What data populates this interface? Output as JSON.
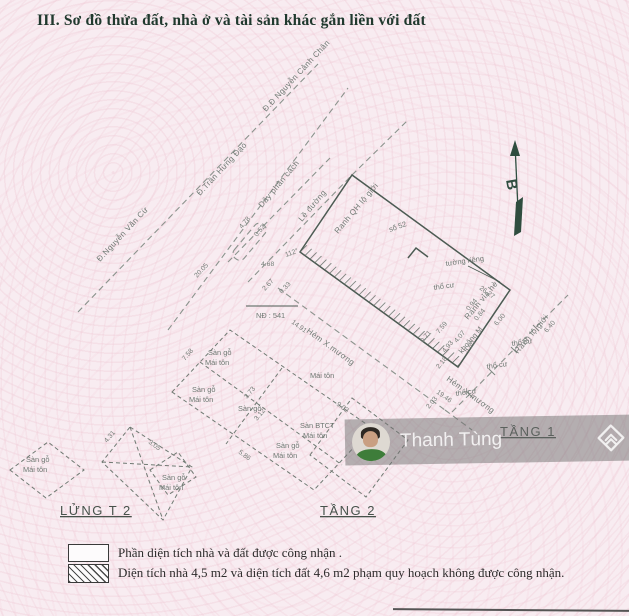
{
  "title": "III. Sơ đồ thửa đất, nhà ở và tài sản khác gắn liền với đất",
  "watermark": {
    "name": "Thanh Tùng",
    "avatar": "man-portrait-photo",
    "logo": "diamond-chevron-logo"
  },
  "legend": {
    "items": [
      {
        "swatch": "empty-box",
        "text": "Phần diện tích nhà và đất được công nhận ."
      },
      {
        "swatch": "hatched-box",
        "text": "Diện tích nhà 4,5 m2 và diện tích đất 4,6 m2 phạm quy hoạch không được công nhận."
      }
    ]
  },
  "colors": {
    "paper": "#f8ecf1",
    "ink": "#20392e",
    "line": "#55645c",
    "band": "rgba(112,112,112,0.5)",
    "shirt_green": "#3e7d3a"
  },
  "diagram": {
    "texts": [
      {
        "t": "Đ.Nguyễn Văn Cừ",
        "x": 100,
        "y": 262,
        "r": -47,
        "c": "road"
      },
      {
        "t": "Đ.Trần Hưng Đạo",
        "x": 200,
        "y": 196,
        "r": -47,
        "c": "road"
      },
      {
        "t": "Đ.Đ Nguyễn Cảnh Chân",
        "x": 266,
        "y": 112,
        "r": -47,
        "c": "road"
      },
      {
        "t": "Dây phân cách",
        "x": 262,
        "y": 208,
        "r": -50,
        "c": "road"
      },
      {
        "t": "Lề đường",
        "x": 302,
        "y": 222,
        "r": -50,
        "c": "road"
      },
      {
        "t": "Ranh QH lộ giới",
        "x": 338,
        "y": 234,
        "r": -50,
        "c": "road"
      },
      {
        "t": "Hẻm X.mương",
        "x": 306,
        "y": 332,
        "r": 36,
        "c": "road"
      },
      {
        "t": "Hẻm X.mương",
        "x": 446,
        "y": 380,
        "r": 36,
        "c": "road"
      },
      {
        "t": "Ranh vỉa hè",
        "x": 468,
        "y": 320,
        "r": -50,
        "c": "road"
      },
      {
        "t": "Ranh lộ giới",
        "x": 518,
        "y": 354,
        "r": -50,
        "c": "road"
      },
      {
        "t": "tường riêng",
        "x": 446,
        "y": 266,
        "r": -8,
        "c": "ann"
      },
      {
        "t": "thổ cư",
        "x": 434,
        "y": 290,
        "r": -8,
        "c": "ann"
      },
      {
        "t": "thổ cư",
        "x": 512,
        "y": 346,
        "r": -8,
        "c": "ann"
      },
      {
        "t": "thổ cư",
        "x": 487,
        "y": 369,
        "r": -8,
        "c": "ann"
      },
      {
        "t": "thổ cư",
        "x": 456,
        "y": 396,
        "r": -8,
        "c": "ann"
      },
      {
        "t": "số 52",
        "x": 390,
        "y": 232,
        "r": -20,
        "c": "ann"
      },
      {
        "t": "NĐ : 541",
        "x": 256,
        "y": 318,
        "r": 0,
        "c": "ann"
      },
      {
        "t": "khoảng M",
        "x": 462,
        "y": 354,
        "r": -50,
        "c": "ann"
      },
      {
        "t": "112°",
        "x": 286,
        "y": 257,
        "r": -20,
        "c": "dim"
      },
      {
        "t": "20.05",
        "x": 197,
        "y": 278,
        "r": -47,
        "c": "dim"
      },
      {
        "t": "4.68",
        "x": 261,
        "y": 266,
        "r": 0,
        "c": "dim"
      },
      {
        "t": "2.67",
        "x": 265,
        "y": 291,
        "r": -47,
        "c": "dim"
      },
      {
        "t": "0.33",
        "x": 282,
        "y": 294,
        "r": -47,
        "c": "dim"
      },
      {
        "t": "4.78",
        "x": 242,
        "y": 229,
        "r": -50,
        "c": "dim"
      },
      {
        "t": "0.52",
        "x": 257,
        "y": 237,
        "r": -50,
        "c": "dim"
      },
      {
        "t": "26.27",
        "x": 479,
        "y": 289,
        "r": 36,
        "c": "dim"
      },
      {
        "t": "0.94",
        "x": 469,
        "y": 311,
        "r": -50,
        "c": "dim"
      },
      {
        "t": "0.84",
        "x": 477,
        "y": 321,
        "r": -50,
        "c": "dim"
      },
      {
        "t": "7.59",
        "x": 439,
        "y": 334,
        "r": -50,
        "c": "dim"
      },
      {
        "t": "4.07",
        "x": 457,
        "y": 343,
        "r": -50,
        "c": "dim"
      },
      {
        "t": "4.93",
        "x": 445,
        "y": 353,
        "r": -50,
        "c": "dim"
      },
      {
        "t": "0.71",
        "x": 423,
        "y": 343,
        "r": -50,
        "c": "dim"
      },
      {
        "t": "14.91",
        "x": 291,
        "y": 323,
        "r": 36,
        "c": "dim"
      },
      {
        "t": "19.46",
        "x": 436,
        "y": 393,
        "r": 36,
        "c": "dim"
      },
      {
        "t": "6.00",
        "x": 497,
        "y": 326,
        "r": -50,
        "c": "dim"
      },
      {
        "t": "6.40",
        "x": 547,
        "y": 333,
        "r": -50,
        "c": "dim"
      },
      {
        "t": "5.80",
        "x": 467,
        "y": 353,
        "r": -50,
        "c": "dim"
      },
      {
        "t": "2.18",
        "x": 439,
        "y": 369,
        "r": -50,
        "c": "dim"
      },
      {
        "t": "2.03",
        "x": 429,
        "y": 409,
        "r": -50,
        "c": "dim"
      },
      {
        "t": "5.86",
        "x": 238,
        "y": 453,
        "r": 36,
        "c": "dim"
      },
      {
        "t": "7.58",
        "x": 185,
        "y": 361,
        "r": -50,
        "c": "dim"
      },
      {
        "t": "9.02",
        "x": 336,
        "y": 405,
        "r": 36,
        "c": "dim"
      },
      {
        "t": "3.12",
        "x": 257,
        "y": 421,
        "r": -50,
        "c": "dim"
      },
      {
        "t": "3.73",
        "x": 247,
        "y": 399,
        "r": -50,
        "c": "dim"
      },
      {
        "t": "3.05",
        "x": 148,
        "y": 443,
        "r": 36,
        "c": "dim"
      },
      {
        "t": "4.31",
        "x": 107,
        "y": 443,
        "r": -50,
        "c": "dim"
      },
      {
        "t": "Sàn gỗ",
        "x": 208,
        "y": 355,
        "r": 0,
        "c": "bld"
      },
      {
        "t": "Mái tôn",
        "x": 205,
        "y": 365,
        "r": 0,
        "c": "bld"
      },
      {
        "t": "Sàn gỗ",
        "x": 192,
        "y": 392,
        "r": 0,
        "c": "bld"
      },
      {
        "t": "Mái tôn",
        "x": 189,
        "y": 402,
        "r": 0,
        "c": "bld"
      },
      {
        "t": "Sàn gỗ",
        "x": 238,
        "y": 411,
        "r": 0,
        "c": "bld"
      },
      {
        "t": "Mái tôn",
        "x": 310,
        "y": 378,
        "r": 0,
        "c": "bld"
      },
      {
        "t": "Sàn BTCT",
        "x": 300,
        "y": 428,
        "r": 0,
        "c": "bld"
      },
      {
        "t": "Mái tôn",
        "x": 303,
        "y": 438,
        "r": 0,
        "c": "bld"
      },
      {
        "t": "Sàn gỗ",
        "x": 276,
        "y": 448,
        "r": 0,
        "c": "bld"
      },
      {
        "t": "Mái tôn",
        "x": 273,
        "y": 458,
        "r": 0,
        "c": "bld"
      },
      {
        "t": "Sàn gỗ",
        "x": 162,
        "y": 480,
        "r": 0,
        "c": "bld"
      },
      {
        "t": "Mái tôn",
        "x": 159,
        "y": 490,
        "r": 0,
        "c": "bld"
      },
      {
        "t": "Sàn gỗ",
        "x": 26,
        "y": 462,
        "r": 0,
        "c": "bld"
      },
      {
        "t": "Mái tôn",
        "x": 23,
        "y": 472,
        "r": 0,
        "c": "bld"
      },
      {
        "t": "TẦNG 1",
        "x": 500,
        "y": 436,
        "r": 0,
        "c": "floor"
      },
      {
        "t": "TẦNG 2",
        "x": 320,
        "y": 515,
        "r": 0,
        "c": "floor"
      },
      {
        "t": "LỬNG T 2",
        "x": 60,
        "y": 515,
        "r": 0,
        "c": "floor"
      },
      {
        "t": "B",
        "x": 506,
        "y": 180,
        "r": 80,
        "c": "compass"
      }
    ]
  }
}
